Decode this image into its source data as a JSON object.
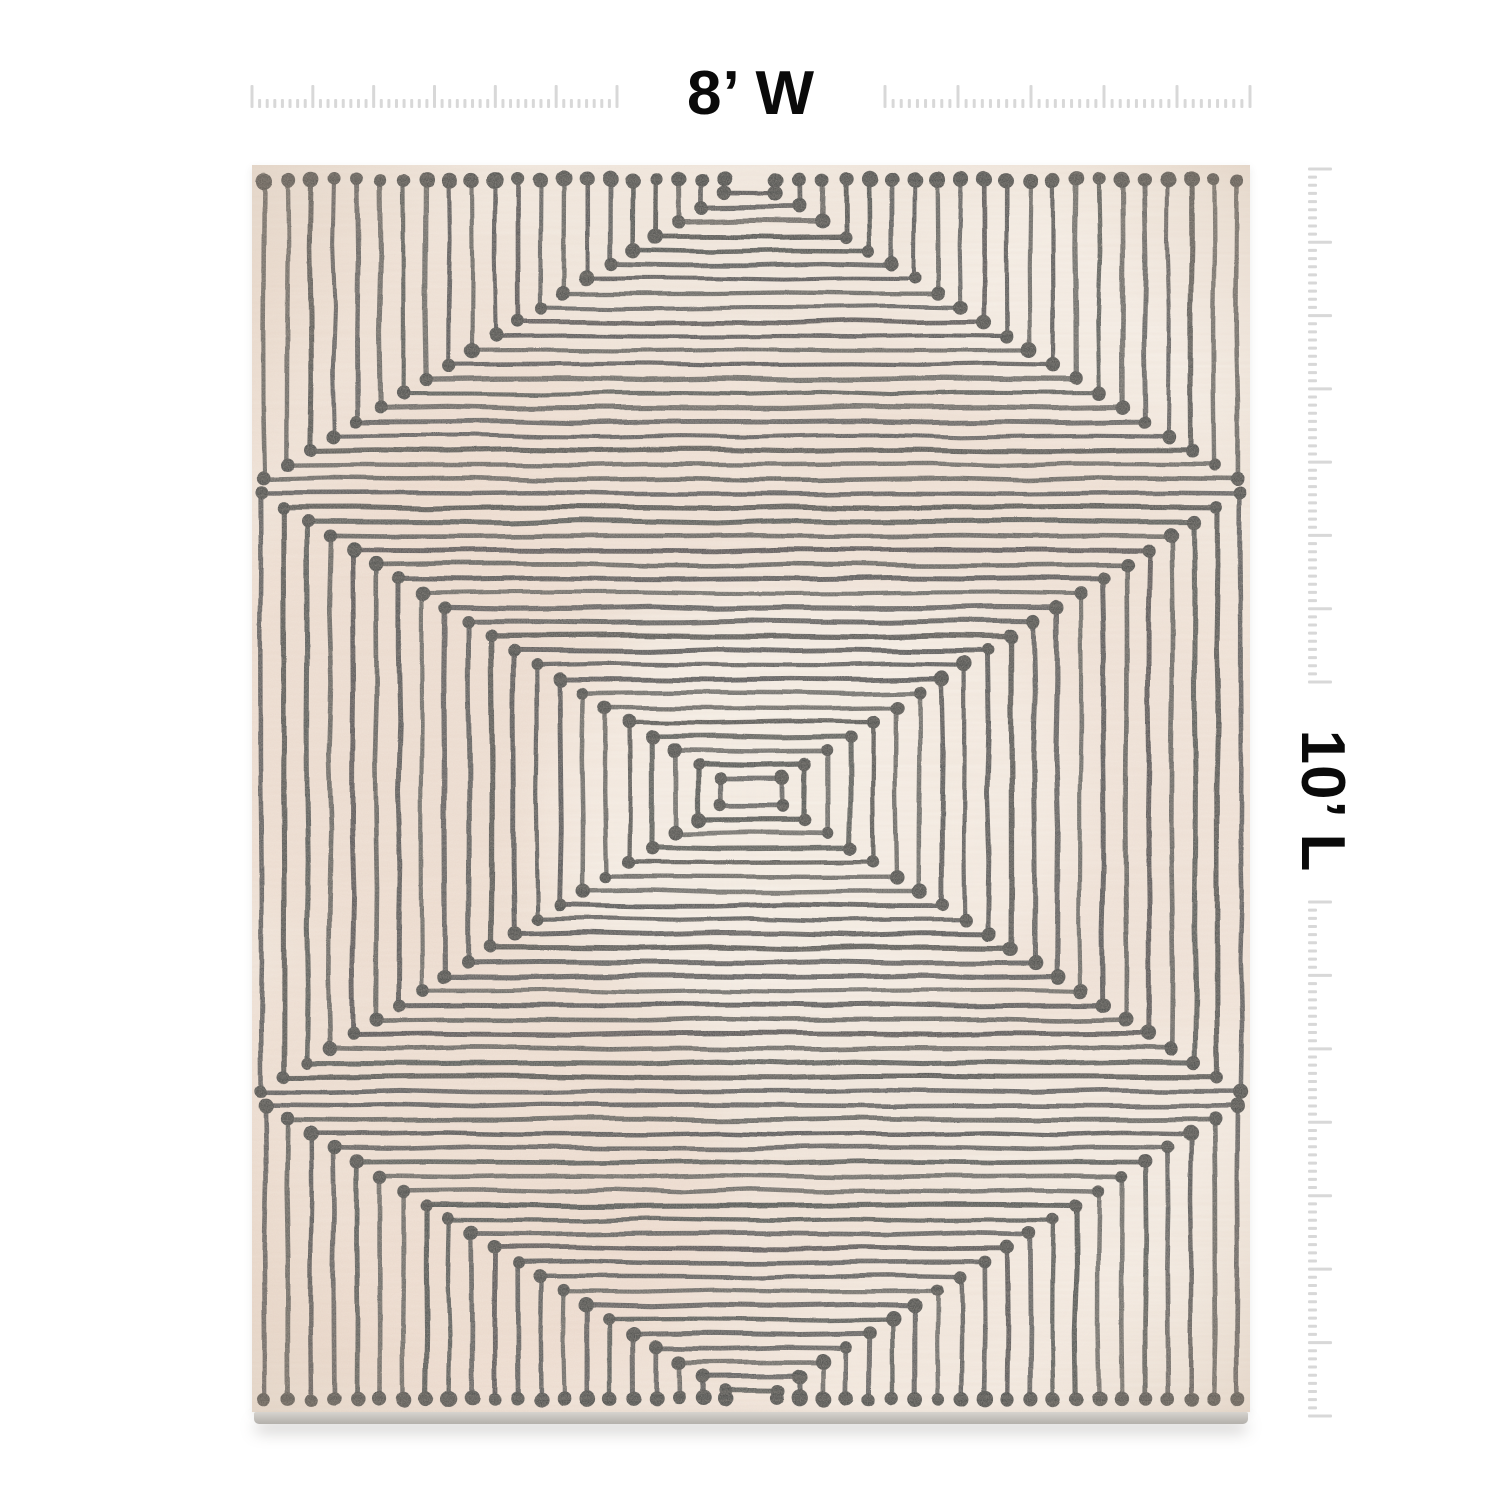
{
  "dimension_labels": {
    "width": "8’ W",
    "length": "10’ L",
    "color": "#0a0a0a"
  },
  "rulers": {
    "tick_color": "#d8d8d8",
    "top": {
      "baseline_y": 108,
      "tick_width": 3,
      "long_len": 23,
      "short_len": 9,
      "segments": [
        {
          "from": 252,
          "to": 617,
          "intervals": 48,
          "long_every": 8
        },
        {
          "from": 885,
          "to": 1250,
          "intervals": 45,
          "long_every": 9
        }
      ]
    },
    "right": {
      "edge_x": 1308,
      "tick_width": 3,
      "long_len": 24,
      "short_len": 9,
      "segments": [
        {
          "from": 169,
          "to": 682,
          "intervals": 63,
          "long_every": 9
        },
        {
          "from": 902,
          "to": 1416,
          "intervals": 63,
          "long_every": 9
        }
      ]
    }
  },
  "rug": {
    "x": 252,
    "y": 165,
    "width": 998,
    "height": 1247,
    "base_color": "#f1e8df",
    "line_color": "#2d3133",
    "dot_color": "#26292b",
    "line_width": 4.6,
    "dot_radius": 6.8,
    "jitter": 1.4,
    "edge_strip": {
      "height": 12,
      "color_top": "#d6d3ce",
      "color_bottom": "#b3b0ab"
    },
    "pattern": {
      "center_x": 499,
      "top_tunnel": {
        "count": 21,
        "inner_half_width": 26,
        "half_width_step": 23,
        "edge_dot_y": 15,
        "inner_corner_y": 28,
        "corner_step": 14.3
      },
      "middle": {
        "count": 21,
        "center_y": 627,
        "inner_half_width": 30,
        "half_width_step": 23,
        "inner_half_height": 13,
        "half_height_step": 14.3
      },
      "bottom_tunnel": {
        "count": 21,
        "inner_half_width": 26,
        "half_width_step": 23,
        "edge_dot_y": 1234,
        "inner_corner_y": 1226,
        "corner_step": 14.3
      }
    },
    "washes": [
      {
        "x": 140,
        "y": 560,
        "rx": 250,
        "ry": 230,
        "color": "#e9d0c1",
        "opacity": 0.5
      },
      {
        "x": 190,
        "y": 1000,
        "rx": 280,
        "ry": 250,
        "color": "#e9d0c1",
        "opacity": 0.45
      },
      {
        "x": 520,
        "y": 310,
        "rx": 430,
        "ry": 130,
        "color": "#ecd4c6",
        "opacity": 0.38
      },
      {
        "x": 880,
        "y": 660,
        "rx": 230,
        "ry": 270,
        "color": "#ecd4c6",
        "opacity": 0.3
      },
      {
        "x": 470,
        "y": 1140,
        "rx": 420,
        "ry": 150,
        "color": "#ecd4c6",
        "opacity": 0.32
      },
      {
        "x": 120,
        "y": 200,
        "rx": 200,
        "ry": 160,
        "color": "#e9d0c1",
        "opacity": 0.3
      },
      {
        "x": 560,
        "y": 640,
        "rx": 270,
        "ry": 210,
        "color": "#fbf7f1",
        "opacity": 0.55
      },
      {
        "x": 900,
        "y": 130,
        "rx": 230,
        "ry": 140,
        "color": "#fbf7f1",
        "opacity": 0.5
      },
      {
        "x": 770,
        "y": 1190,
        "rx": 250,
        "ry": 130,
        "color": "#fbf7f1",
        "opacity": 0.4
      },
      {
        "x": 900,
        "y": 1000,
        "rx": 200,
        "ry": 150,
        "color": "#fbf7f1",
        "opacity": 0.3
      }
    ]
  }
}
